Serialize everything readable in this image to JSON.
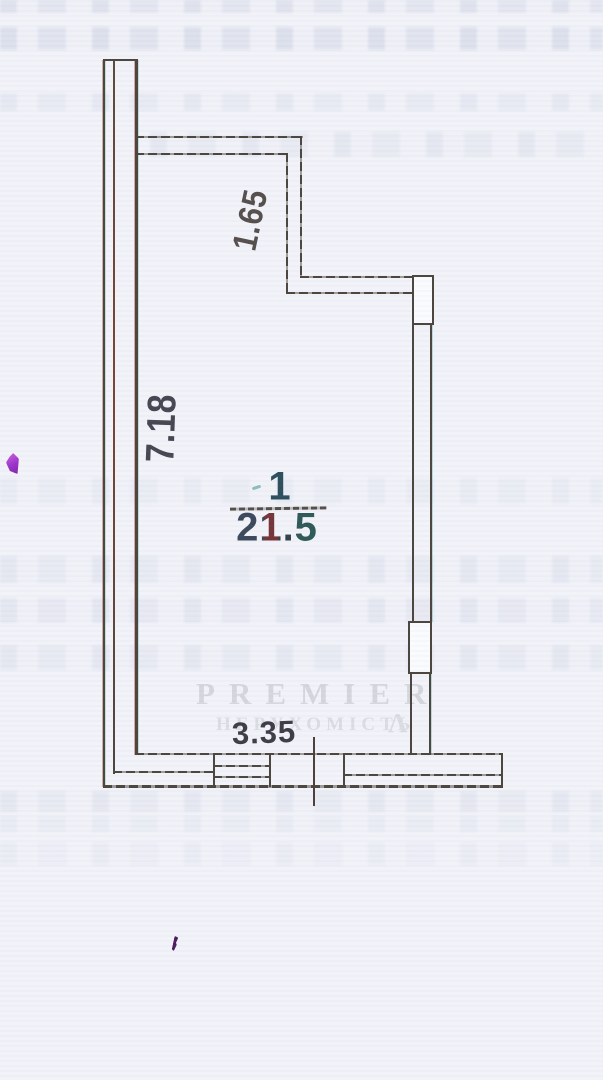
{
  "plan": {
    "room": {
      "number": "1",
      "area": "21.5"
    },
    "dimensions": {
      "left_wall_height": "7.18",
      "alcove_depth": "1.65",
      "bottom_width": "3.35"
    }
  },
  "watermark": {
    "brand": "PREMIER",
    "subtitle": "НЕРУХОМІСТЬ",
    "logo_mark": "Λ"
  },
  "colors": {
    "wall": "#4c463f",
    "dimension_text": "#43424c",
    "watermark": "#d5d7dd",
    "background": "#f2f3f9",
    "magenta_mark": "#b44fd6"
  }
}
